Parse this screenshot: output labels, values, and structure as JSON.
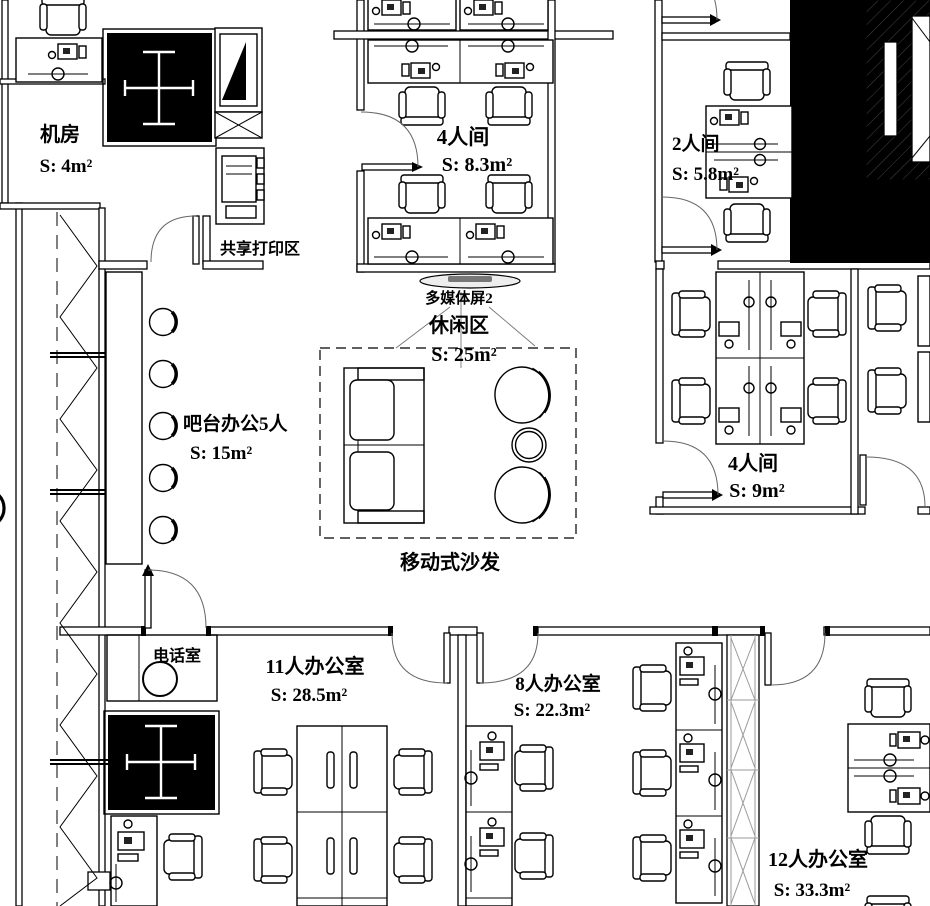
{
  "rooms": {
    "machine_room": {
      "name": "机房",
      "area": "S: 4m²"
    },
    "room4_top": {
      "name": "4人间",
      "area": "S: 8.3m²"
    },
    "room2": {
      "name": "2人间",
      "area": "S: 5.8m²"
    },
    "leisure": {
      "name": "休闲区",
      "area": "S: 25m²"
    },
    "bar": {
      "name": "吧台办公5人",
      "area": "S: 15m²"
    },
    "room4_right": {
      "name": "4人间",
      "area": "S: 9m²"
    },
    "office11": {
      "name": "11人办公室",
      "area": "S: 28.5m²"
    },
    "office8": {
      "name": "8人办公室",
      "area": "S: 22.3m²"
    },
    "office12": {
      "name": "12人办公室",
      "area": "S: 33.3m²"
    }
  },
  "labels": {
    "shared_print": "共享打印区",
    "media_screen": "多媒体屏2",
    "mobile_sofa": "移动式沙发",
    "phone_room": "电话室",
    "paren": "）"
  },
  "colors": {
    "line": "#000000",
    "shaft_fill": "#000000",
    "hatch": "#444444",
    "xmark": "#9a9a9a"
  }
}
